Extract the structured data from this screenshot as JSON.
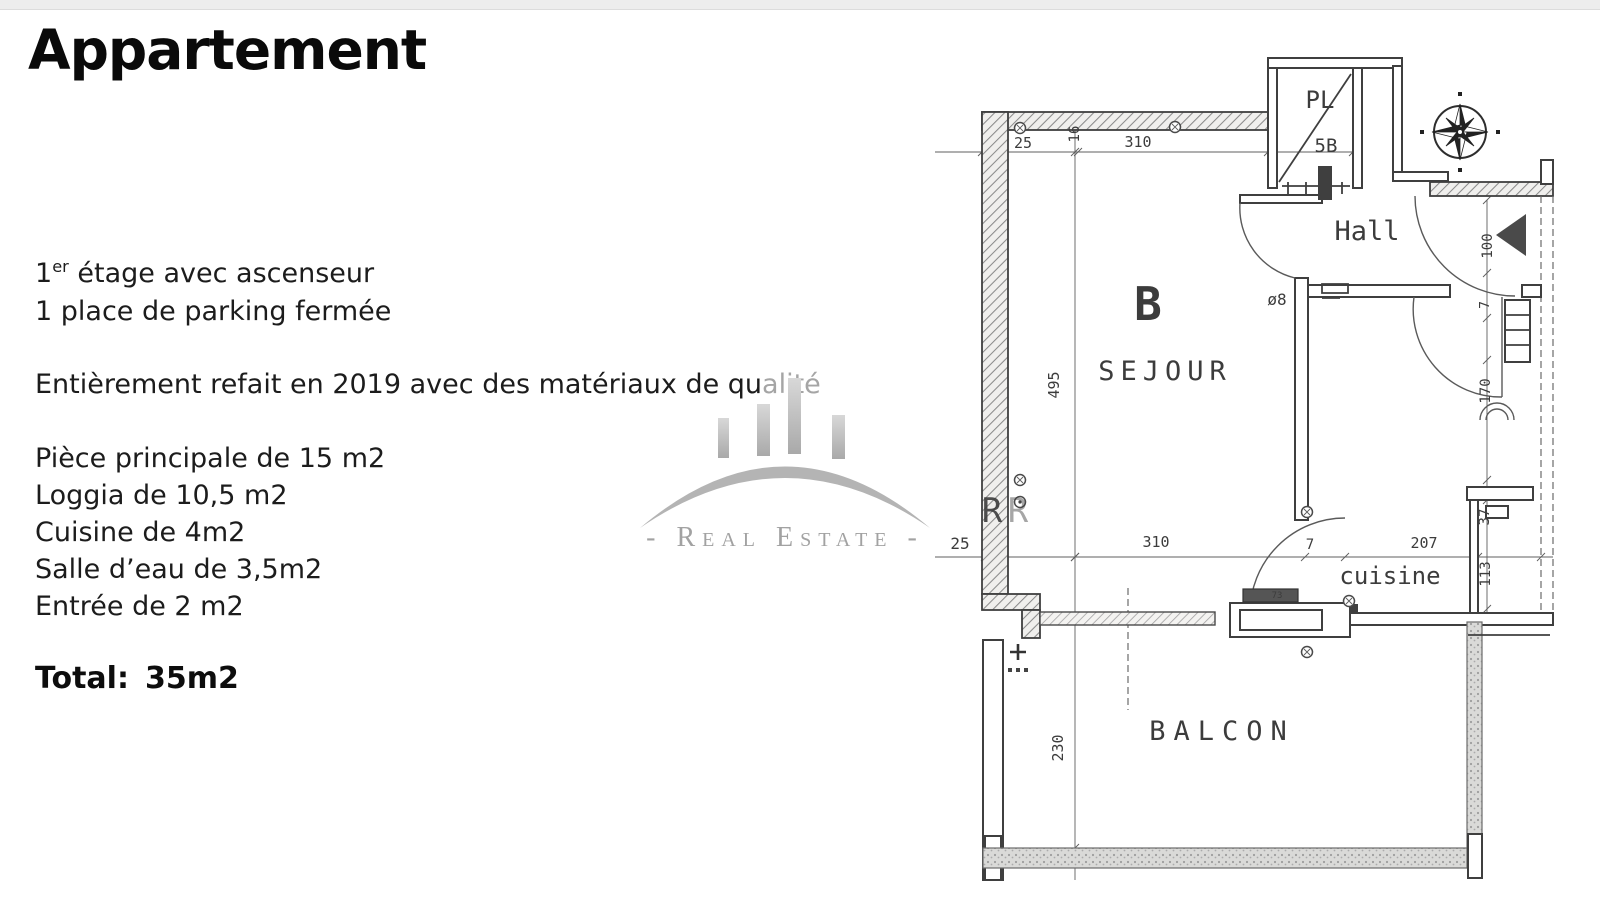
{
  "document": {
    "title": "Appartement",
    "intro": {
      "floor_num": "1",
      "floor_sup": "er",
      "floor_rest": " étage avec ascenseur",
      "parking": "1 place de parking fermée"
    },
    "renovation": {
      "dark": "Entièrement refait en 2019 avec des matériaux de qu",
      "faded": "alité"
    },
    "rooms": [
      "Pièce principale de 15 m2",
      "Loggia de 10,5 m2",
      "Cuisine de 4m2",
      "Salle d’eau de 3,5m2",
      "Entrée de 2 m2"
    ],
    "total_label": "Total:",
    "total_value": "35m2"
  },
  "watermark": {
    "line": "- Real Estate -",
    "logo": "arch-skyline-logo",
    "color": "#b4b4b4"
  },
  "plan": {
    "room_labels": [
      "B",
      "SEJOUR",
      "Hall",
      "cuisine",
      "BALCON",
      "PL"
    ],
    "labels": [
      {
        "t": "PL",
        "x": 390,
        "y": 60,
        "s": 24
      },
      {
        "t": "5B",
        "x": 396,
        "y": 104,
        "s": 19
      },
      {
        "t": "Hall",
        "x": 437,
        "y": 192,
        "s": 27
      },
      {
        "t": "B",
        "x": 218,
        "y": 272,
        "s": 46,
        "w": "bold"
      },
      {
        "t": "SEJOUR",
        "x": 235,
        "y": 332,
        "s": 27,
        "ls": 6
      },
      {
        "t": "ø8",
        "x": 347,
        "y": 257,
        "s": 16
      },
      {
        "t": "cuisine",
        "x": 460,
        "y": 536,
        "s": 24
      },
      {
        "t": "BALCON",
        "x": 292,
        "y": 692,
        "s": 27,
        "ls": 8
      },
      {
        "t": "73",
        "x": 347,
        "y": 550,
        "s": 9
      },
      {
        "t": "25",
        "x": 93,
        "y": 100,
        "s": 15
      },
      {
        "t": "16",
        "x": 149,
        "y": 86,
        "s": 14,
        "r": -90
      },
      {
        "t": "310",
        "x": 208,
        "y": 99,
        "s": 15
      },
      {
        "t": "495",
        "x": 129,
        "y": 337,
        "s": 15,
        "r": -90
      },
      {
        "t": "25",
        "x": 30,
        "y": 501,
        "s": 16
      },
      {
        "t": "310",
        "x": 226,
        "y": 499,
        "s": 15
      },
      {
        "t": "7",
        "x": 380,
        "y": 501,
        "s": 14
      },
      {
        "t": "207",
        "x": 494,
        "y": 500,
        "s": 15
      },
      {
        "t": "100",
        "x": 562,
        "y": 198,
        "s": 14,
        "r": -90
      },
      {
        "t": "7",
        "x": 559,
        "y": 257,
        "s": 13,
        "r": -90
      },
      {
        "t": "170",
        "x": 560,
        "y": 343,
        "s": 14,
        "r": -90
      },
      {
        "t": "37",
        "x": 559,
        "y": 469,
        "s": 14,
        "r": -90
      },
      {
        "t": "113",
        "x": 560,
        "y": 526,
        "s": 14,
        "r": -90
      },
      {
        "t": "230",
        "x": 133,
        "y": 700,
        "s": 15,
        "r": -90
      },
      {
        "t": "R",
        "x": 62,
        "y": 474,
        "s": 34,
        "fill": "#ffffff",
        "serif": true,
        "o": 0.9
      },
      {
        "t": "R",
        "x": 88,
        "y": 474,
        "s": 34,
        "fill": "#ffffff",
        "serif": true,
        "o": 0.45
      }
    ]
  }
}
